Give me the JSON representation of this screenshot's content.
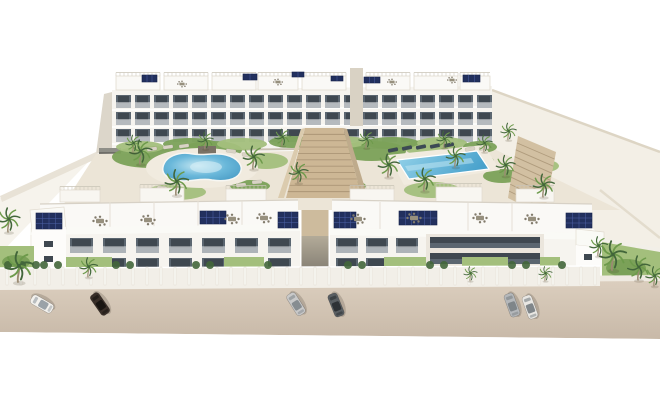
{
  "meta": {
    "subject": "Aerial 3D architectural rendering of a white residential apartment complex with courtyard pools, palm trees, rooftop solar panels and cars parked on a street"
  },
  "palette": {
    "sky": "#ffffff",
    "building_white": "#f6f4ef",
    "building_side": "#dcd6ca",
    "roof_white": "#faf9f6",
    "parapet_line": "#d7d1c6",
    "window_glass": "#5b6670",
    "window_dark": "#3f4850",
    "solar_panel": "#22305e",
    "solar_grid": "#4e63a8",
    "pool_deck": "#f1ebdf",
    "grass": "#7ba158",
    "grass_light": "#a3bf7c",
    "palm_green": "#6d9a4b",
    "palm_green_dark": "#42663a",
    "palm_trunk": "#9b8b72",
    "street": "#d3c4b4",
    "curb": "#efeae1",
    "wall_white": "#f2efe8",
    "stairs_tan": "#cdb795",
    "furniture_gray": "#97907e",
    "ground_side": "#f3efe6"
  },
  "scene": {
    "back_row": {
      "x0": 116,
      "step": 19,
      "count": 20,
      "win_w": 15,
      "win_h": 13,
      "floor_y": [
        95,
        112,
        129
      ]
    },
    "roof_boxes": [
      {
        "x": 116,
        "w": 44
      },
      {
        "x": 164,
        "w": 44
      },
      {
        "x": 212,
        "w": 44
      },
      {
        "x": 258,
        "w": 40
      },
      {
        "x": 302,
        "w": 44
      },
      {
        "x": 366,
        "w": 44
      },
      {
        "x": 414,
        "w": 44
      },
      {
        "x": 460,
        "w": 30
      }
    ],
    "front_left_windows": {
      "xs": [
        70,
        103,
        136,
        169,
        202,
        235,
        268
      ],
      "w": 23,
      "rows": [
        {
          "y": 238,
          "h": 15
        },
        {
          "y": 258,
          "h": 16
        }
      ]
    },
    "front_right_windows": {
      "xs": [
        336,
        366,
        396
      ],
      "w": 22,
      "rows": [
        {
          "y": 238,
          "h": 15
        },
        {
          "y": 258,
          "h": 16
        }
      ]
    },
    "railings": [
      {
        "x": 60,
        "w": 40,
        "y": 190
      },
      {
        "x": 140,
        "w": 44,
        "y": 188
      },
      {
        "x": 226,
        "w": 40,
        "y": 189
      },
      {
        "x": 350,
        "w": 44,
        "y": 189
      },
      {
        "x": 436,
        "w": 46,
        "y": 187
      },
      {
        "x": 516,
        "w": 38,
        "y": 189
      }
    ],
    "stairs_central": {
      "tl": [
        305,
        128
      ],
      "tr": [
        343,
        128
      ],
      "bl": [
        286,
        198
      ],
      "br": [
        362,
        198
      ],
      "steps": 11
    },
    "stairs_side": {
      "tl": [
        518,
        136
      ],
      "tr": [
        556,
        152
      ],
      "bl": [
        508,
        198
      ],
      "br": [
        544,
        216
      ],
      "steps": 9
    },
    "green_patches": [
      {
        "cx": 150,
        "cy": 157,
        "rx": 38,
        "ry": 11,
        "tone": "dark"
      },
      {
        "cx": 212,
        "cy": 150,
        "rx": 30,
        "ry": 9,
        "tone": "dark"
      },
      {
        "cx": 266,
        "cy": 161,
        "rx": 22,
        "ry": 8,
        "tone": "light"
      },
      {
        "cx": 176,
        "cy": 192,
        "rx": 30,
        "ry": 8,
        "tone": "light"
      },
      {
        "cx": 250,
        "cy": 186,
        "rx": 20,
        "ry": 6,
        "tone": "dark"
      },
      {
        "cx": 372,
        "cy": 151,
        "rx": 34,
        "ry": 10,
        "tone": "dark"
      },
      {
        "cx": 432,
        "cy": 148,
        "rx": 27,
        "ry": 9,
        "tone": "light"
      },
      {
        "cx": 470,
        "cy": 161,
        "rx": 24,
        "ry": 8,
        "tone": "dark"
      },
      {
        "cx": 432,
        "cy": 190,
        "rx": 28,
        "ry": 8,
        "tone": "light"
      },
      {
        "cx": 502,
        "cy": 176,
        "rx": 19,
        "ry": 7,
        "tone": "dark"
      },
      {
        "cx": 545,
        "cy": 166,
        "rx": 14,
        "ry": 6,
        "tone": "light"
      },
      {
        "cx": 314,
        "cy": 166,
        "rx": 12,
        "ry": 5,
        "tone": "light"
      },
      {
        "cx": 352,
        "cy": 186,
        "rx": 14,
        "ry": 5,
        "tone": "dark"
      },
      {
        "cx": 140,
        "cy": 147,
        "rx": 24,
        "ry": 6,
        "tone": "light"
      },
      {
        "cx": 190,
        "cy": 144,
        "rx": 27,
        "ry": 6,
        "tone": "dark"
      },
      {
        "cx": 242,
        "cy": 144,
        "rx": 25,
        "ry": 6,
        "tone": "light"
      },
      {
        "cx": 292,
        "cy": 142,
        "rx": 23,
        "ry": 6,
        "tone": "dark"
      },
      {
        "cx": 342,
        "cy": 142,
        "rx": 25,
        "ry": 6,
        "tone": "light"
      },
      {
        "cx": 392,
        "cy": 143,
        "rx": 27,
        "ry": 6,
        "tone": "dark"
      },
      {
        "cx": 442,
        "cy": 143,
        "rx": 25,
        "ry": 6,
        "tone": "light"
      },
      {
        "cx": 480,
        "cy": 147,
        "rx": 17,
        "ry": 6,
        "tone": "dark"
      }
    ],
    "lawns": [
      {
        "x": 66,
        "w": 46
      },
      {
        "x": 224,
        "w": 40
      },
      {
        "x": 384,
        "w": 42
      },
      {
        "x": 462,
        "w": 46
      },
      {
        "x": 540,
        "w": 20
      }
    ],
    "pillars": {
      "x0": 6,
      "x1": 596,
      "step": 14,
      "y": 267,
      "h": 18
    },
    "hedges": [
      8,
      22,
      36,
      44,
      58,
      116,
      130,
      196,
      210,
      268,
      348,
      362,
      430,
      444,
      512,
      526,
      562
    ],
    "loungers": [
      {
        "x": 393,
        "y": 150,
        "a": -12,
        "tone": "dark"
      },
      {
        "x": 407,
        "y": 148,
        "a": -12,
        "tone": "dark"
      },
      {
        "x": 421,
        "y": 147,
        "a": -12,
        "tone": "dark"
      },
      {
        "x": 435,
        "y": 146,
        "a": -12,
        "tone": "dark"
      },
      {
        "x": 449,
        "y": 145,
        "a": -12,
        "tone": "dark"
      },
      {
        "x": 152,
        "y": 149,
        "a": -8,
        "tone": "light"
      },
      {
        "x": 168,
        "y": 147,
        "a": -8,
        "tone": "light"
      },
      {
        "x": 184,
        "y": 146,
        "a": -8,
        "tone": "light"
      },
      {
        "x": 231,
        "y": 151,
        "a": 8,
        "tone": "light"
      },
      {
        "x": 247,
        "y": 155,
        "a": 8,
        "tone": "light"
      },
      {
        "x": 162,
        "y": 188,
        "a": 5,
        "tone": "light"
      },
      {
        "x": 178,
        "y": 190,
        "a": 5,
        "tone": "light"
      },
      {
        "x": 241,
        "y": 185,
        "a": -5,
        "tone": "light"
      },
      {
        "x": 257,
        "y": 182,
        "a": -5,
        "tone": "light"
      },
      {
        "x": 470,
        "y": 149,
        "a": -12,
        "tone": "light"
      },
      {
        "x": 484,
        "y": 148,
        "a": -12,
        "tone": "light"
      }
    ],
    "solar_arrays": [
      {
        "x": 142,
        "y": 75,
        "w": 15,
        "h": 7
      },
      {
        "x": 243,
        "y": 74,
        "w": 14,
        "h": 6
      },
      {
        "x": 292,
        "y": 72,
        "w": 12,
        "h": 5
      },
      {
        "x": 331,
        "y": 76,
        "w": 12,
        "h": 5
      },
      {
        "x": 364,
        "y": 77,
        "w": 16,
        "h": 6
      },
      {
        "x": 463,
        "y": 75,
        "w": 17,
        "h": 7
      },
      {
        "x": 36,
        "y": 213,
        "w": 26,
        "h": 16
      },
      {
        "x": 200,
        "y": 211,
        "w": 26,
        "h": 13
      },
      {
        "x": 278,
        "y": 212,
        "w": 20,
        "h": 16
      },
      {
        "x": 334,
        "y": 212,
        "w": 22,
        "h": 16
      },
      {
        "x": 399,
        "y": 211,
        "w": 38,
        "h": 14
      },
      {
        "x": 566,
        "y": 213,
        "w": 26,
        "h": 15
      }
    ],
    "furniture": [
      {
        "x": 100,
        "y": 221
      },
      {
        "x": 148,
        "y": 220
      },
      {
        "x": 232,
        "y": 219
      },
      {
        "x": 264,
        "y": 218
      },
      {
        "x": 358,
        "y": 219
      },
      {
        "x": 414,
        "y": 218
      },
      {
        "x": 480,
        "y": 218
      },
      {
        "x": 532,
        "y": 219
      },
      {
        "x": 182,
        "y": 84,
        "s": 0.65
      },
      {
        "x": 278,
        "y": 82,
        "s": 0.65
      },
      {
        "x": 392,
        "y": 82,
        "s": 0.65
      },
      {
        "x": 452,
        "y": 80,
        "s": 0.65
      }
    ],
    "cars": [
      {
        "name": "car-white",
        "x": 42,
        "y": 304,
        "angle": -150,
        "body": "#f3f1ed",
        "glass": "#9aa2a8"
      },
      {
        "name": "car-dark-brown",
        "x": 100,
        "y": 304,
        "angle": -125,
        "body": "#3a2f29",
        "glass": "#191512"
      },
      {
        "name": "car-silver",
        "x": 296,
        "y": 304,
        "angle": -122,
        "body": "#c9c9c9",
        "glass": "#878d91"
      },
      {
        "name": "car-gray",
        "x": 336,
        "y": 305,
        "angle": -112,
        "body": "#5a5f63",
        "glass": "#2e3236"
      },
      {
        "name": "car-silver-2",
        "x": 512,
        "y": 305,
        "angle": -110,
        "body": "#b5b8bb",
        "glass": "#7f8589"
      },
      {
        "name": "car-white-2",
        "x": 530,
        "y": 307,
        "angle": -110,
        "body": "#e9e7e3",
        "glass": "#80868a"
      }
    ],
    "palms": [
      {
        "x": 8,
        "y": 232,
        "s": 1.0
      },
      {
        "x": 18,
        "y": 282,
        "s": 1.25
      },
      {
        "x": 88,
        "y": 277,
        "s": 0.8
      },
      {
        "x": 140,
        "y": 164,
        "s": 1.0
      },
      {
        "x": 176,
        "y": 195,
        "s": 1.05
      },
      {
        "x": 253,
        "y": 169,
        "s": 0.95
      },
      {
        "x": 298,
        "y": 183,
        "s": 0.85
      },
      {
        "x": 388,
        "y": 177,
        "s": 0.95
      },
      {
        "x": 424,
        "y": 191,
        "s": 0.95
      },
      {
        "x": 455,
        "y": 167,
        "s": 0.85
      },
      {
        "x": 505,
        "y": 176,
        "s": 0.85
      },
      {
        "x": 543,
        "y": 197,
        "s": 0.95
      },
      {
        "x": 508,
        "y": 140,
        "s": 0.7
      },
      {
        "x": 133,
        "y": 152,
        "s": 0.7
      },
      {
        "x": 205,
        "y": 149,
        "s": 0.7
      },
      {
        "x": 282,
        "y": 146,
        "s": 0.7
      },
      {
        "x": 366,
        "y": 148,
        "s": 0.7
      },
      {
        "x": 444,
        "y": 148,
        "s": 0.7
      },
      {
        "x": 484,
        "y": 152,
        "s": 0.7
      },
      {
        "x": 470,
        "y": 281,
        "s": 0.6
      },
      {
        "x": 545,
        "y": 281,
        "s": 0.6
      },
      {
        "x": 612,
        "y": 270,
        "s": 1.2
      },
      {
        "x": 638,
        "y": 280,
        "s": 1.0
      },
      {
        "x": 654,
        "y": 286,
        "s": 0.8
      },
      {
        "x": 598,
        "y": 256,
        "s": 0.8
      }
    ]
  }
}
